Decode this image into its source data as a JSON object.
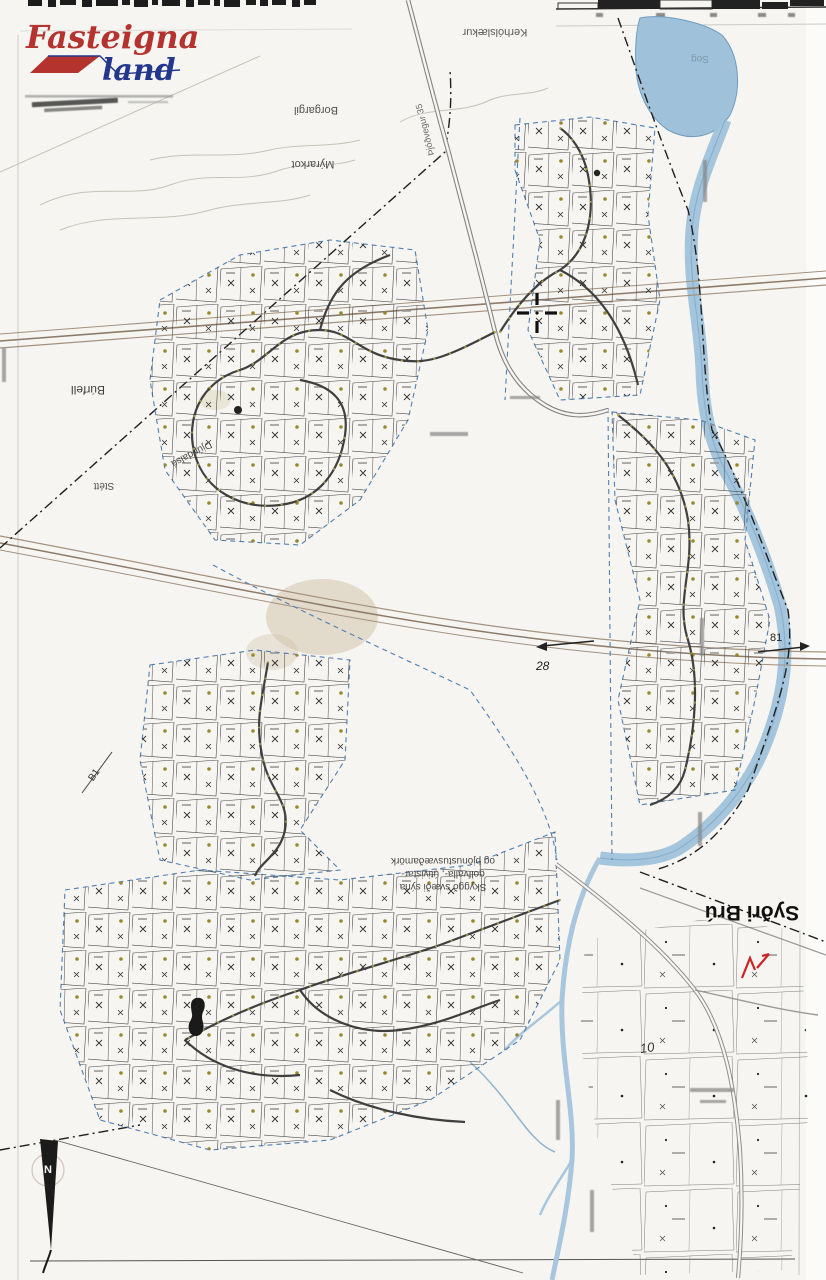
{
  "logo": {
    "word_top": "Fasteigna",
    "word_bottom": "land"
  },
  "map_labels": {
    "top_stream": "Kerhólslækur",
    "gully": "Borgargil",
    "farm_small": "Mýrarkot",
    "road_35": "Þjóðvegur 35",
    "river": "Sog",
    "hill": "Búrfell",
    "creek": "Djúpdalsá",
    "stett": "Stétt",
    "farm_main": "Syðri Brú"
  },
  "annotation_note": {
    "line1": "Skyggð svæði sýna",
    "line2": "golfvalla-, útivistar-",
    "line3": "og þjónustusvæðamörk"
  },
  "markers": {
    "section_b2": "28",
    "section_81": "81",
    "section_b1": "B1",
    "plot_10": "10",
    "north": "N"
  },
  "colors": {
    "logo_red": "#b5332e",
    "logo_blue": "#23378f",
    "water": "#9fc2da",
    "plot_boundary_blue": "#4f7fb5",
    "annotation_red": "#cc2222"
  },
  "cursor": {
    "type": "crosshair"
  }
}
